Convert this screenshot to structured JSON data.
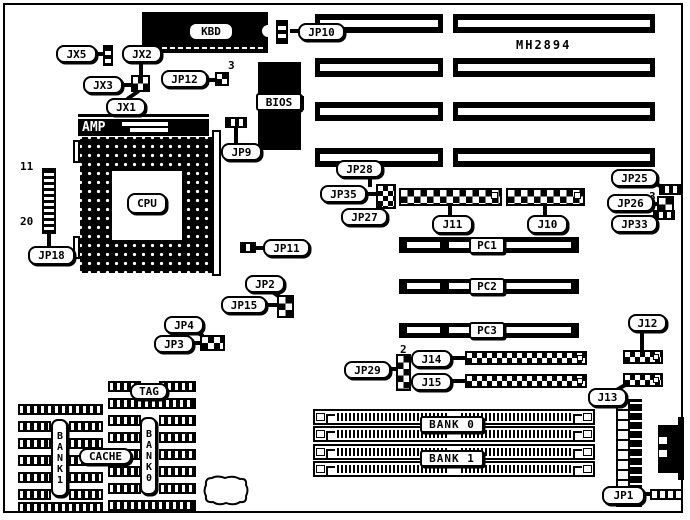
{
  "part_number": "MH2894",
  "chips": {
    "kbd": "KBD",
    "bios": "BIOS",
    "cpu": "CPU",
    "amp": "AMP"
  },
  "slots": {
    "pc1": "PC1",
    "pc2": "PC2",
    "pc3": "PC3"
  },
  "memory": {
    "bank0": "BANK 0",
    "bank1": "BANK 1"
  },
  "cache": {
    "tag": "TAG",
    "cache": "CACHE",
    "bank0_col": "BANK0",
    "bank1_col": "BANK1"
  },
  "callouts": {
    "jx5": "JX5",
    "jx2": "JX2",
    "jx3": "JX3",
    "jx1": "JX1",
    "jp12": "JP12",
    "jp10": "JP10",
    "jp9": "JP9",
    "jp18": "JP18",
    "jp11": "JP11",
    "jp2": "JP2",
    "jp15": "JP15",
    "jp4": "JP4",
    "jp3": "JP3",
    "jp28": "JP28",
    "jp35": "JP35",
    "jp27": "JP27",
    "j11": "J11",
    "j10": "J10",
    "jp25": "JP25",
    "jp26": "JP26",
    "jp33": "JP33",
    "jp29": "JP29",
    "j14": "J14",
    "j15": "J15",
    "j12": "J12",
    "j13": "J13",
    "jp1": "JP1"
  },
  "pin_numbers": {
    "jp18_top": "11",
    "jp18_bottom": "20",
    "jp12_pin3": "3",
    "jp26_pin3": "3",
    "jp29_pin2": "2"
  },
  "colors": {
    "ink": "#000000",
    "paper": "#ffffff"
  }
}
